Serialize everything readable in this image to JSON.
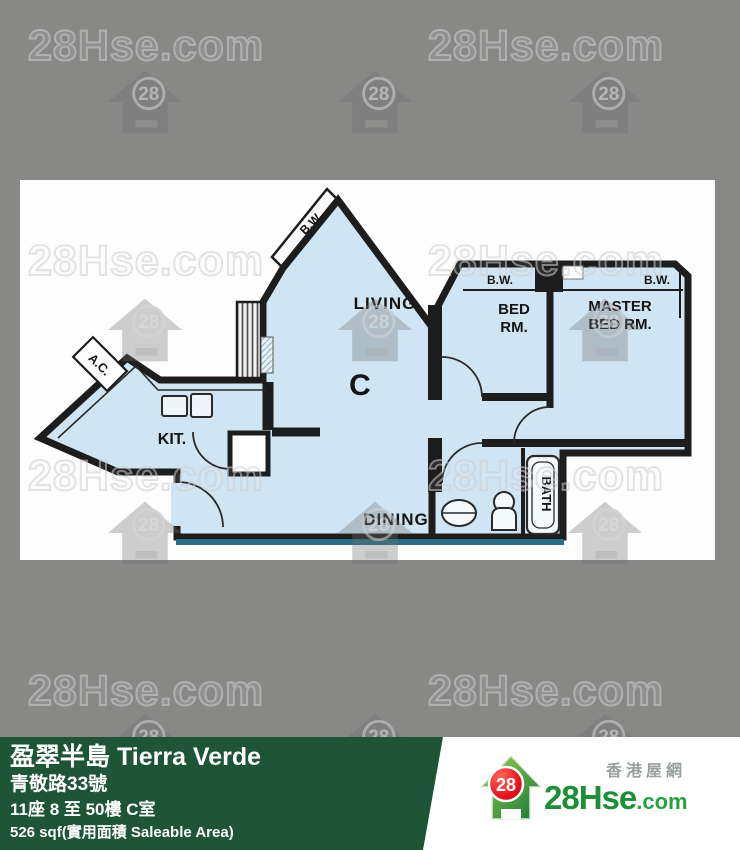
{
  "watermark": {
    "text": "28Hse.com",
    "badge": "28"
  },
  "floorplan": {
    "labels": {
      "living": "LIVING",
      "dining": "DINING",
      "kitchen": "KIT.",
      "unit": "C",
      "bed_line1": "BED",
      "bed_line2": "RM.",
      "master_line1": "MASTER",
      "master_line2": "BED RM.",
      "bath": "BATH",
      "bay_window": "B.W.",
      "ac": "A.C."
    },
    "colors": {
      "room_fill": "#cfe5f3",
      "wall": "#1d1d1d",
      "shadow_line": "#2a6d85"
    }
  },
  "info_bar": {
    "background": "#1e5536",
    "title": "盈翠半島 Tierra Verde",
    "address": "青敬路33號",
    "block_floor_unit": "11座 8 至 50樓 C室",
    "area": "526 sqf(實用面積 Saleable Area)"
  },
  "logo": {
    "site_name_cn": "香港屋網",
    "brand": "28Hse",
    "brand_suffix": ".com",
    "badge": "28",
    "brand_color": "#1e8f38",
    "badge_color": "#e8151d"
  }
}
